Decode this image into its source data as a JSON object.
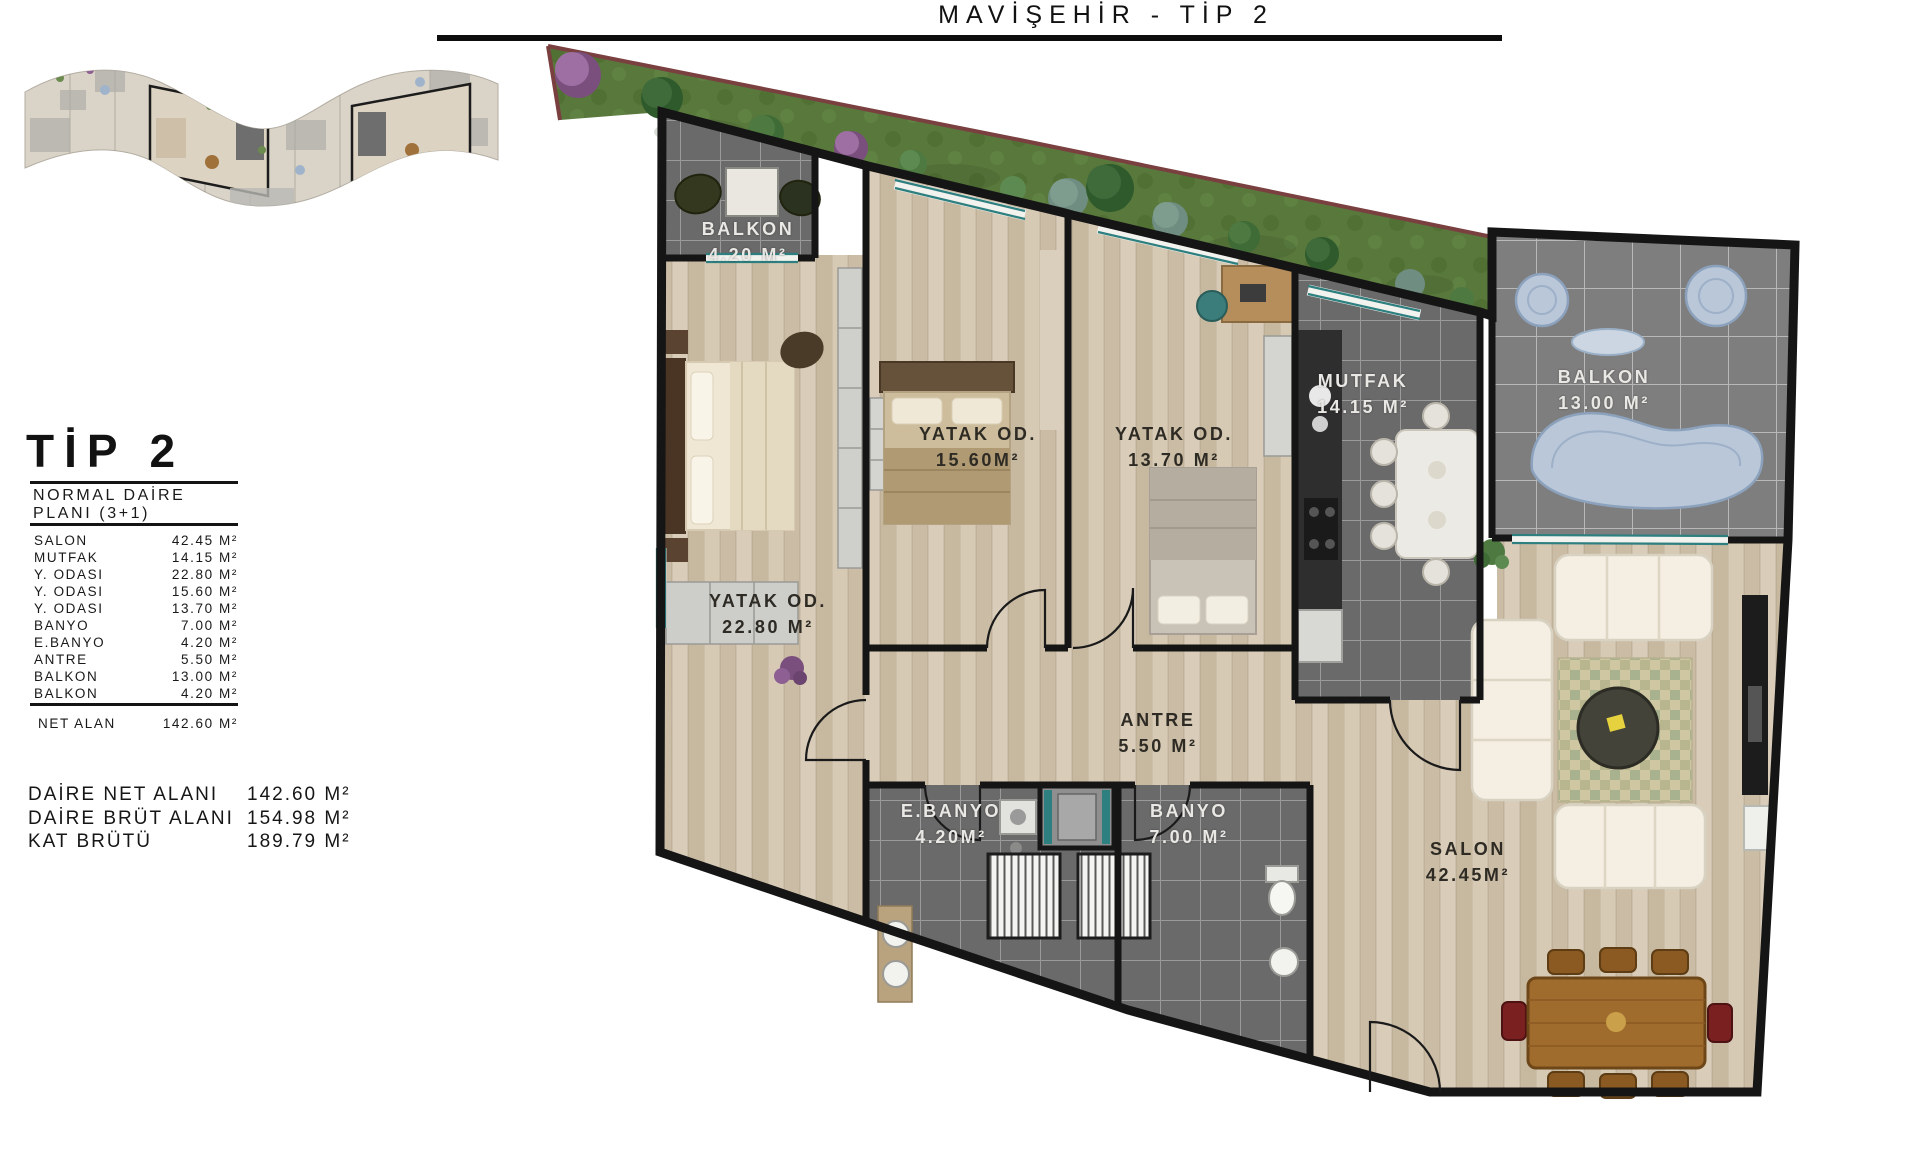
{
  "title": "MAVİŞEHİR - TİP 2",
  "info_panel": {
    "heading": "TİP 2",
    "subtitle_line1": "NORMAL DAİRE",
    "subtitle_line2": "PLANI  (3+1)",
    "rooms": [
      {
        "label": "SALON",
        "area": "42.45 M²"
      },
      {
        "label": "MUTFAK",
        "area": "14.15 M²"
      },
      {
        "label": "Y. ODASI",
        "area": "22.80 M²"
      },
      {
        "label": "Y. ODASI",
        "area": "15.60 M²"
      },
      {
        "label": "Y. ODASI",
        "area": "13.70 M²"
      },
      {
        "label": "BANYO",
        "area": "7.00 M²"
      },
      {
        "label": "E.BANYO",
        "area": "4.20 M²"
      },
      {
        "label": "ANTRE",
        "area": "5.50 M²"
      },
      {
        "label": "BALKON",
        "area": "13.00 M²"
      },
      {
        "label": "BALKON",
        "area": "4.20 M²"
      }
    ],
    "net": {
      "label": "NET ALAN",
      "area": "142.60 M²"
    },
    "totals": [
      {
        "label": "DAİRE NET ALANI",
        "area": "142.60 M²"
      },
      {
        "label": "DAİRE BRÜT ALANI",
        "area": "154.98 M²"
      },
      {
        "label": "KAT BRÜTÜ",
        "area": "189.79 M²"
      }
    ]
  },
  "plan_labels": [
    {
      "id": "balkon-420",
      "name": "BALKON",
      "area": "4.20 M²"
    },
    {
      "id": "yatak-1560",
      "name": "YATAK OD.",
      "area": "15.60M²"
    },
    {
      "id": "yatak-1370",
      "name": "YATAK OD.",
      "area": "13.70 M²"
    },
    {
      "id": "mutfak",
      "name": "MUTFAK",
      "area": "14.15 M²"
    },
    {
      "id": "balkon-1300",
      "name": "BALKON",
      "area": "13.00 M²"
    },
    {
      "id": "yatak-2280",
      "name": "YATAK OD.",
      "area": "22.80 M²"
    },
    {
      "id": "antre",
      "name": "ANTRE",
      "area": "5.50 M²"
    },
    {
      "id": "ebanyo",
      "name": "E.BANYO",
      "area": "4.20M²"
    },
    {
      "id": "banyo",
      "name": "BANYO",
      "area": "7.00 M²"
    },
    {
      "id": "salon",
      "name": "SALON",
      "area": "42.45M²"
    }
  ],
  "colors": {
    "wall": "#151515",
    "wood_floor": "#d2c4ae",
    "dark_tile": "#6a6a6a",
    "light_tile": "#7e7e7e",
    "grass": "#59783c",
    "site_line": "#7a4040",
    "balcony_furniture_blue": "#b9c7d8",
    "window_teal": "#2e7f7f",
    "label_dark": "#2e2b24",
    "label_light": "#e9e8e4"
  }
}
